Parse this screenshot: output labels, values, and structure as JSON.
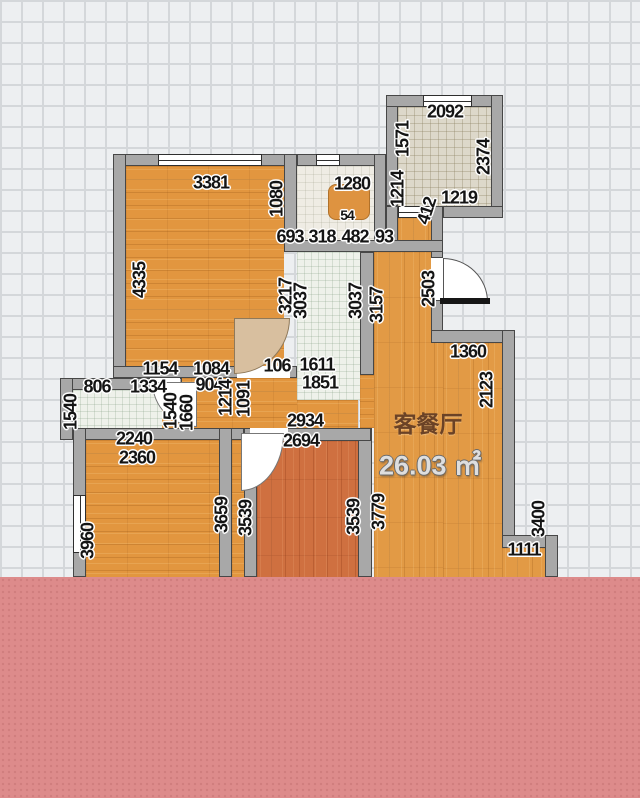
{
  "room": {
    "name": "客餐厅",
    "area": "26.03 ㎡"
  },
  "dimensions": [
    {
      "t": "3381",
      "x": 211,
      "y": 183,
      "v": false
    },
    {
      "t": "2092",
      "x": 445,
      "y": 112,
      "v": false
    },
    {
      "t": "1280",
      "x": 352,
      "y": 184,
      "v": false
    },
    {
      "t": "54",
      "x": 347,
      "y": 215,
      "v": false,
      "s": true
    },
    {
      "t": "693",
      "x": 290,
      "y": 237,
      "v": false
    },
    {
      "t": "318",
      "x": 322,
      "y": 237,
      "v": false
    },
    {
      "t": "482",
      "x": 355,
      "y": 237,
      "v": false
    },
    {
      "t": "93",
      "x": 384,
      "y": 237,
      "v": false
    },
    {
      "t": "1219",
      "x": 459,
      "y": 198,
      "v": false
    },
    {
      "t": "1154",
      "x": 160,
      "y": 369,
      "v": false
    },
    {
      "t": "1084",
      "x": 211,
      "y": 369,
      "v": false
    },
    {
      "t": "806",
      "x": 97,
      "y": 387,
      "v": false
    },
    {
      "t": "1334",
      "x": 148,
      "y": 387,
      "v": false
    },
    {
      "t": "904",
      "x": 209,
      "y": 385,
      "v": false
    },
    {
      "t": "2240",
      "x": 134,
      "y": 439,
      "v": false
    },
    {
      "t": "2360",
      "x": 137,
      "y": 458,
      "v": false
    },
    {
      "t": "106",
      "x": 277,
      "y": 366,
      "v": false
    },
    {
      "t": "1611",
      "x": 317,
      "y": 365,
      "v": false
    },
    {
      "t": "1851",
      "x": 320,
      "y": 383,
      "v": false
    },
    {
      "t": "2934",
      "x": 305,
      "y": 421,
      "v": false
    },
    {
      "t": "2694",
      "x": 301,
      "y": 441,
      "v": false
    },
    {
      "t": "1360",
      "x": 468,
      "y": 352,
      "v": false
    },
    {
      "t": "1111",
      "x": 524,
      "y": 550,
      "v": false
    },
    {
      "t": "1080",
      "x": 277,
      "y": 199,
      "v": true
    },
    {
      "t": "4335",
      "x": 140,
      "y": 280,
      "v": true
    },
    {
      "t": "3217",
      "x": 286,
      "y": 296,
      "v": true
    },
    {
      "t": "3037",
      "x": 301,
      "y": 301,
      "v": true
    },
    {
      "t": "3037",
      "x": 356,
      "y": 301,
      "v": true
    },
    {
      "t": "3157",
      "x": 377,
      "y": 305,
      "v": true
    },
    {
      "t": "2503",
      "x": 429,
      "y": 289,
      "v": true
    },
    {
      "t": "1571",
      "x": 403,
      "y": 139,
      "v": true
    },
    {
      "t": "1214",
      "x": 398,
      "y": 189,
      "v": true
    },
    {
      "t": "412",
      "x": 427,
      "y": 211,
      "v": true,
      "r": -72
    },
    {
      "t": "2374",
      "x": 484,
      "y": 157,
      "v": true
    },
    {
      "t": "2123",
      "x": 487,
      "y": 390,
      "v": true
    },
    {
      "t": "3400",
      "x": 539,
      "y": 519,
      "v": true
    },
    {
      "t": "3960",
      "x": 88,
      "y": 541,
      "v": true
    },
    {
      "t": "3659",
      "x": 222,
      "y": 515,
      "v": true
    },
    {
      "t": "3539",
      "x": 246,
      "y": 518,
      "v": true
    },
    {
      "t": "3539",
      "x": 354,
      "y": 517,
      "v": true
    },
    {
      "t": "3779",
      "x": 379,
      "y": 512,
      "v": true
    },
    {
      "t": "1540",
      "x": 71,
      "y": 412,
      "v": true
    },
    {
      "t": "1540",
      "x": 171,
      "y": 411,
      "v": true
    },
    {
      "t": "1660",
      "x": 187,
      "y": 413,
      "v": true
    },
    {
      "t": "1214",
      "x": 226,
      "y": 398,
      "v": true
    },
    {
      "t": "1091",
      "x": 244,
      "y": 399,
      "v": true
    }
  ],
  "colors": {
    "pink_overlay": "#dd8b8b",
    "wood_floor": "#e2963f",
    "red_wood_floor": "#cf7040",
    "tile_light": "#eef1ea",
    "tile_beige": "#ddd8ca",
    "wall": "#a8a8a8",
    "grid_line": "#d4d7da",
    "grid_bg": "#edeff1",
    "room_name_color": "#6b4226",
    "area_text_color": "#dedede"
  }
}
